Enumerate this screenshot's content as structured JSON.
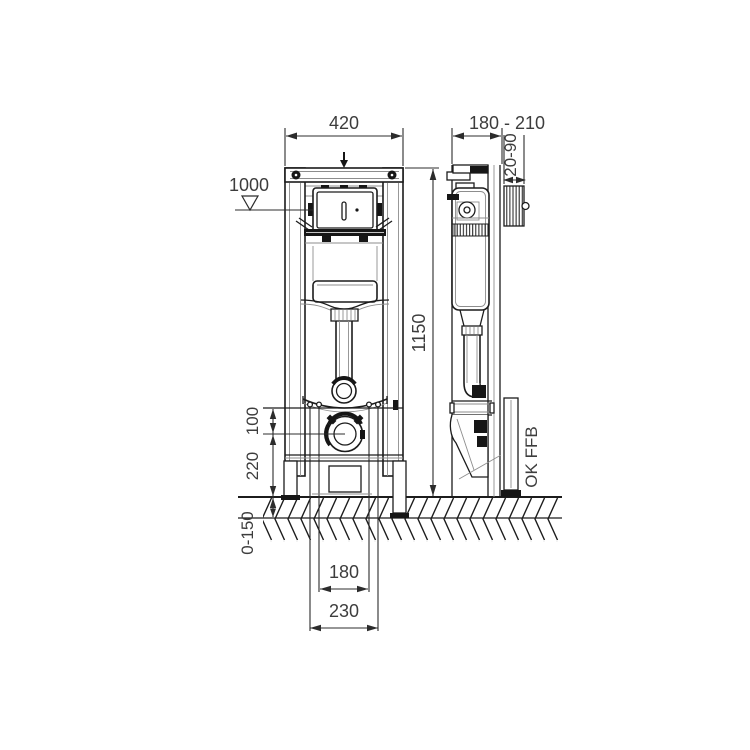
{
  "drawing": {
    "labels": {
      "front_width": "420",
      "depth_range": "180 - 210",
      "finish_depth": "20-90",
      "actuation_height": "1000",
      "frame_height": "1150",
      "outlet_drop": "100",
      "outlet_height": "220",
      "foot_adjust": "0-150",
      "fixing_inner": "180",
      "fixing_outer": "230",
      "floor_ref": "OK FFB"
    },
    "colors": {
      "line": "#1c1c1c",
      "dim_text": "#3d3d3d",
      "background": "#ffffff"
    }
  }
}
